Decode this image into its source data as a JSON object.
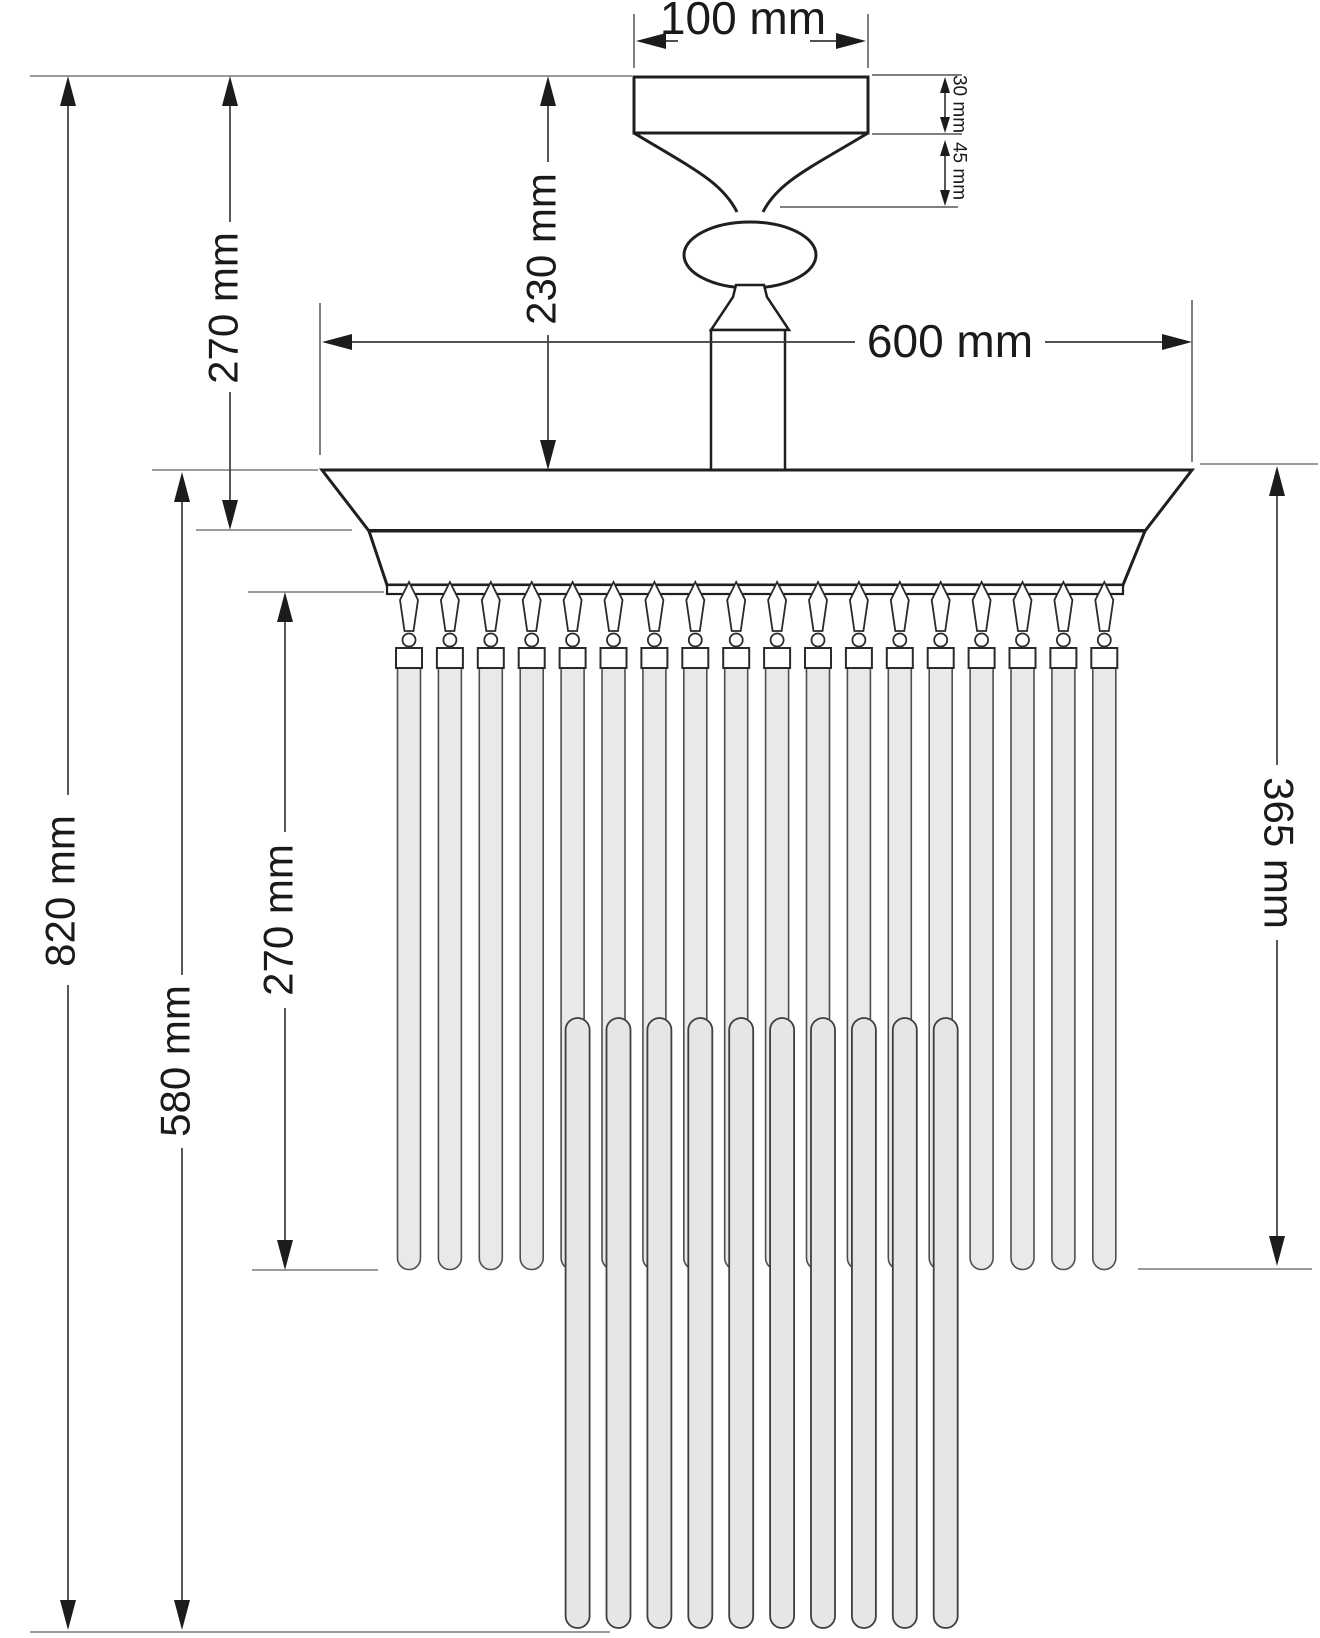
{
  "dimensions": {
    "canopy_width": "100 mm",
    "canopy_height": "30 mm",
    "neck_height": "45 mm",
    "ceiling_to_body_top": "230 mm",
    "ceiling_to_band": "270 mm",
    "body_diameter": "600 mm",
    "total_height": "820 mm",
    "body_top_to_bottom": "580 mm",
    "short_rod_drop": "270 mm",
    "right_side_drop": "365 mm"
  },
  "structure": {
    "short_rod_count": 18,
    "long_rod_count": 10
  },
  "colors": {
    "outline": "#1f1f1f",
    "dimension_line": "#3a3a3a",
    "extension_line": "#9b9b9b",
    "extension_line_dark": "#555555",
    "rod_fill": "#e9e9e9",
    "long_rod_fill": "#e6e6e6",
    "rod_stroke": "#4f4f4f",
    "background": "#ffffff"
  }
}
